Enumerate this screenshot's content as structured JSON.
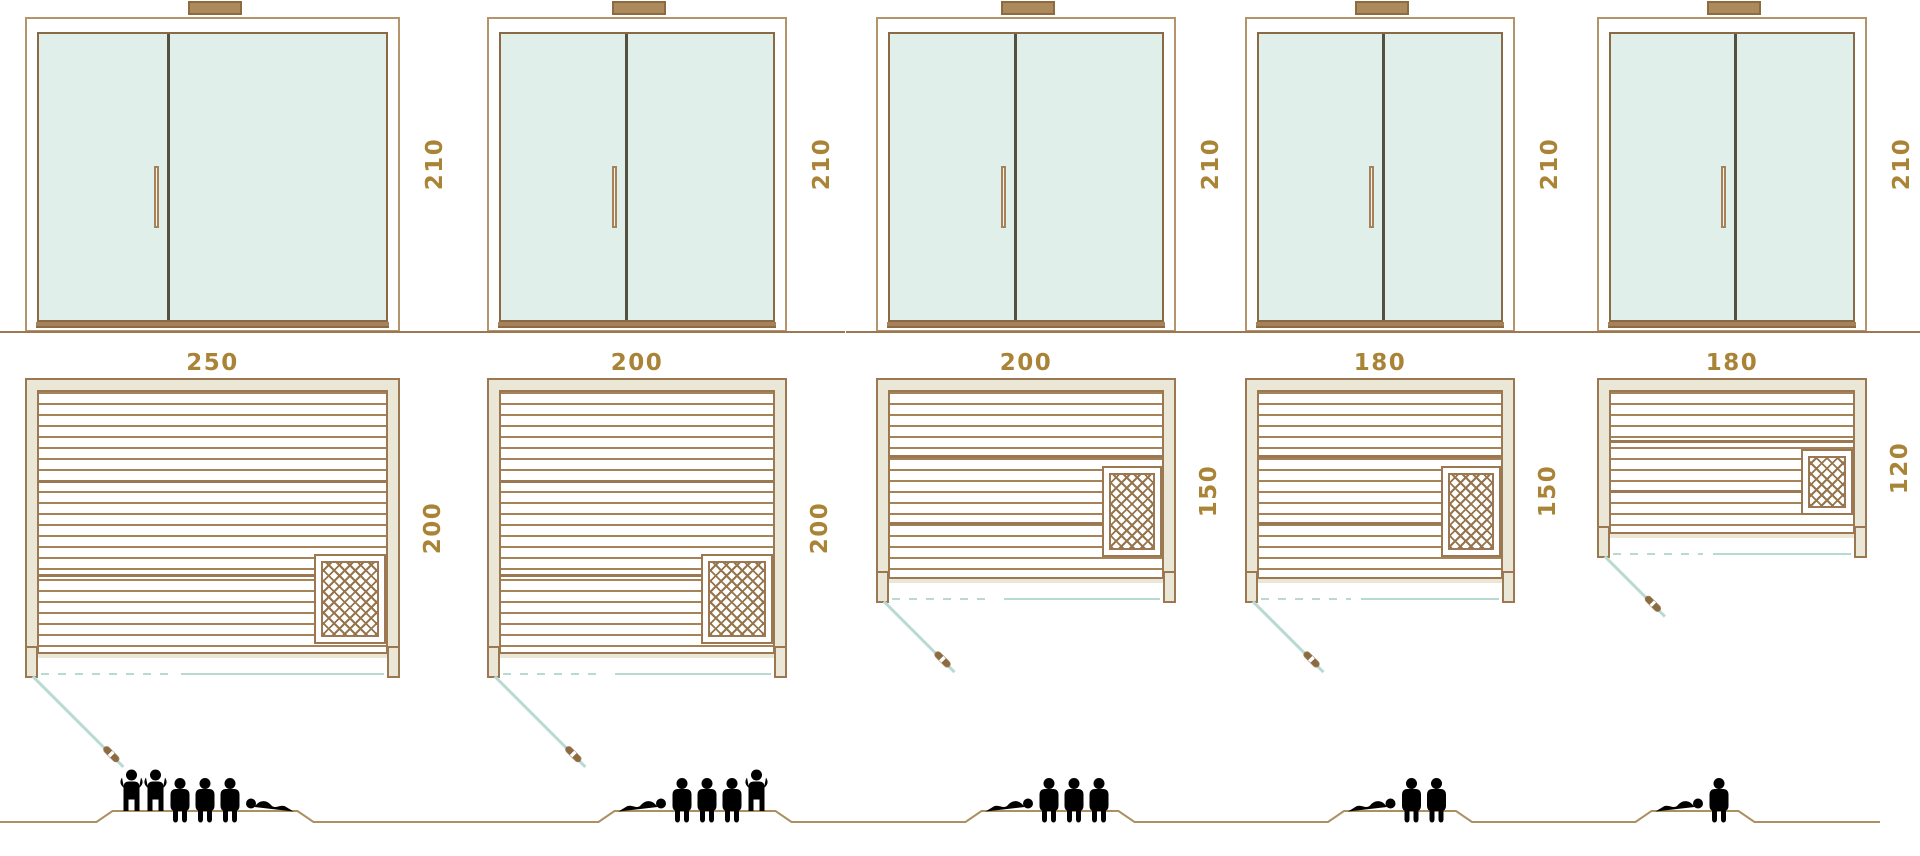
{
  "diagram": {
    "type": "sauna-size-comparison",
    "views": {
      "top_row": "front-elevation-glass-doors",
      "middle_row": "floor-plan",
      "bottom_row": "capacity-pictograms"
    },
    "panels": [
      {
        "name": "sauna-250x200",
        "height_label": "210",
        "width_label": "250",
        "depth_label": "200",
        "height_cm": 210,
        "width_cm": 250,
        "depth_cm": 200,
        "capacity": 6,
        "capacity_figures": [
          "standing",
          "standing",
          "seated",
          "seated",
          "seated",
          "lying"
        ]
      },
      {
        "name": "sauna-200x200",
        "height_label": "210",
        "width_label": "200",
        "depth_label": "200",
        "height_cm": 210,
        "width_cm": 200,
        "depth_cm": 200,
        "capacity": 5,
        "capacity_figures": [
          "lying",
          "seated",
          "seated",
          "seated",
          "standing"
        ]
      },
      {
        "name": "sauna-200x150",
        "height_label": "210",
        "width_label": "200",
        "depth_label": "150",
        "height_cm": 210,
        "width_cm": 200,
        "depth_cm": 150,
        "capacity": 4,
        "capacity_figures": [
          "lying",
          "seated",
          "seated",
          "seated"
        ]
      },
      {
        "name": "sauna-180x150",
        "height_label": "210",
        "width_label": "180",
        "depth_label": "150",
        "height_cm": 210,
        "width_cm": 180,
        "depth_cm": 150,
        "capacity": 3,
        "capacity_figures": [
          "lying",
          "seated",
          "seated"
        ]
      },
      {
        "name": "sauna-180x120",
        "height_label": "210",
        "width_label": "180",
        "depth_label": "120",
        "height_cm": 210,
        "width_cm": 180,
        "depth_cm": 120,
        "capacity": 2,
        "capacity_figures": [
          "lying",
          "seated"
        ]
      }
    ],
    "icons": {
      "heater": "crosshatch-square",
      "door_swing": "diagonal-line-with-handle",
      "chimney": "roof-vent-bar",
      "capacity": [
        "person-standing",
        "person-seated",
        "person-lying"
      ]
    },
    "colors": {
      "outline_brown": "#9b7851",
      "light_frame_brown": "#b3946b",
      "dimension_text": "#a98336",
      "frame_fill_beige": "#eae7d6",
      "glass_fill": "#e1efeb",
      "door_divider": "#55503f",
      "door_swing_teal": "#b9dad3",
      "figure_brown": "#ab9061"
    }
  }
}
